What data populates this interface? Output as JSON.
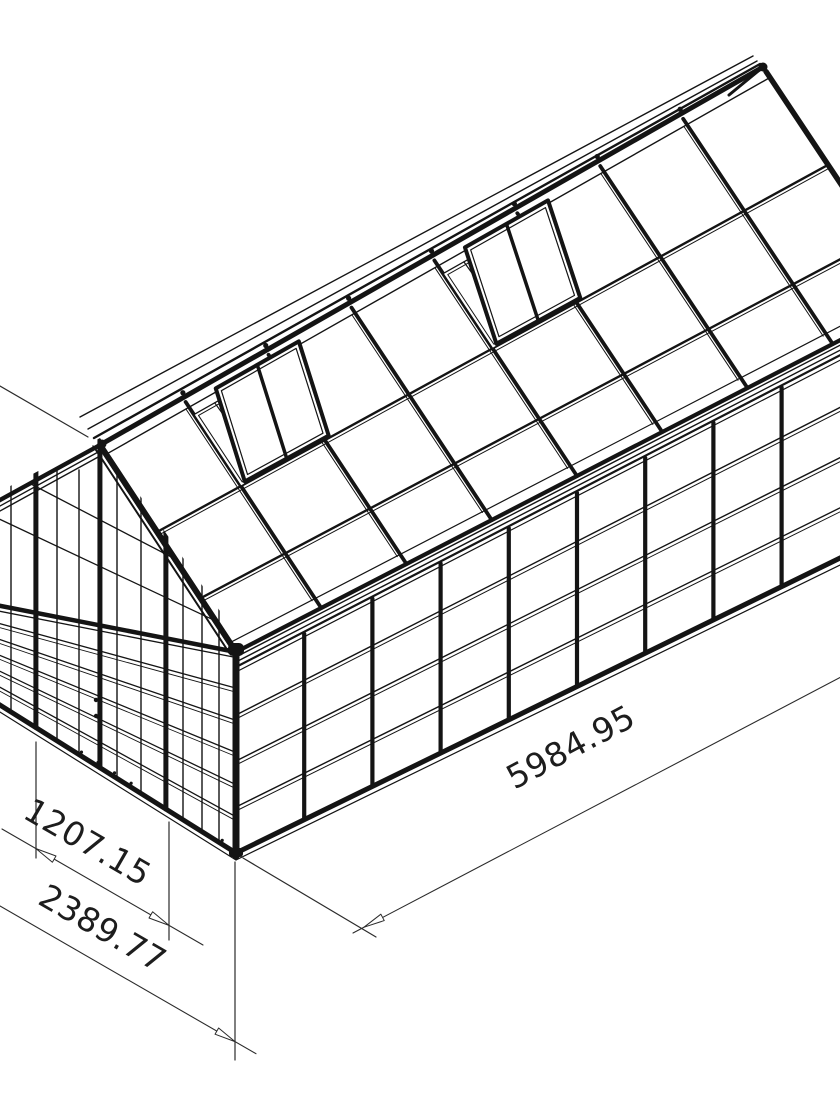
{
  "drawing": {
    "subject": "Greenhouse",
    "view": "isometric CAD wireframe",
    "background": "#ffffff",
    "line_color": "#141414",
    "dim_color": "#2b2b2b"
  },
  "dimensions": [
    {
      "id": "side_length",
      "label": "5984.95"
    },
    {
      "id": "door_width",
      "label": "1207.15"
    },
    {
      "id": "gable_width",
      "label": "2389.77"
    }
  ],
  "structure": {
    "wall_bays": 10,
    "wall_rows": 4,
    "roof_bays": 8,
    "roof_vents": 2,
    "door_leaves": 2,
    "front_rows": 6
  }
}
